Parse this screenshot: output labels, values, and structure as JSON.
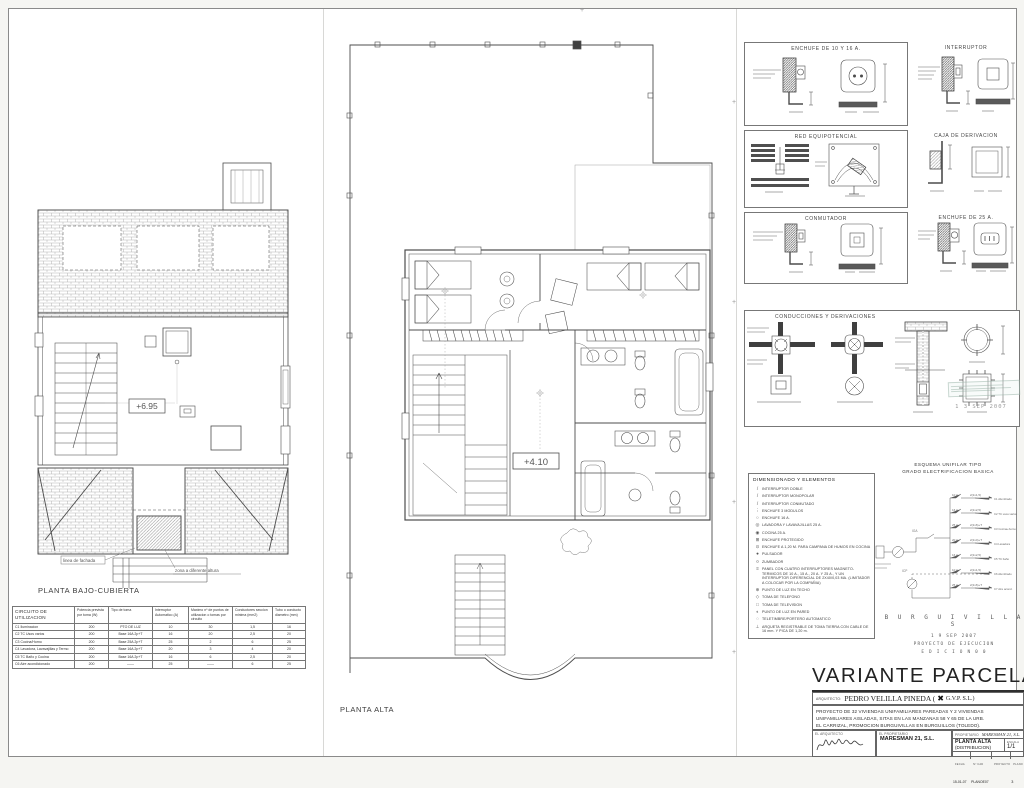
{
  "plans": {
    "left_label": "PLANTA BAJO-CUBIERTA",
    "center_label": "PLANTA ALTA",
    "level_left": "+6.95",
    "level_center": "+4.10",
    "ann_fachada": "linea de fachada",
    "ann_zona": "zona a diferente altura"
  },
  "details": {
    "boxes": [
      {
        "title": "ENCHUFE DE 10 Y 16 A."
      },
      {
        "title": "INTERRUPTOR"
      },
      {
        "title": "RED EQUIPOTENCIAL"
      },
      {
        "title": "CAJA DE DERIVACION"
      },
      {
        "title": "CONMUTADOR"
      },
      {
        "title": "ENCHUFE DE 25 A."
      },
      {
        "title": "CONDUCCIONES Y DERIVACIONES"
      }
    ]
  },
  "legend": {
    "title": "DIMENSIONADO Y ELEMENTOS",
    "items": [
      {
        "icon": "/",
        "text": "INTERRUPTOR DOBLE"
      },
      {
        "icon": "/",
        "text": "INTERRUPTOR MONOPOLAR"
      },
      {
        "icon": "/",
        "text": "INTERRUPTOR CONMUTADO"
      },
      {
        "icon": "⋮",
        "text": "ENCHUFE 3 MODULOS"
      },
      {
        "icon": "○",
        "text": "ENCHUFE 16 A."
      },
      {
        "icon": "◎",
        "text": "LAVADORA Y LAVAVAJILLAS 25 A."
      },
      {
        "icon": "◉",
        "text": "COCINA 25 A."
      },
      {
        "icon": "⊞",
        "text": "ENCHUFE PROTEGIDO"
      },
      {
        "icon": "⊙",
        "text": "ENCHUFE A 1,20 M. PARA CAMPANA DE HUMOS EN COCINA"
      },
      {
        "icon": "●",
        "text": "PULSADOR"
      },
      {
        "icon": "¤",
        "text": "ZUMBADOR"
      },
      {
        "icon": "≡",
        "text": "PANEL CON CUATRO INTERRUPTORES MAGNETO-TERMICOS DE 10 A., 15 A., 20 A. Y 25 A., Y UN INTERRUPTOR DIFERENCIAL DE 2X40/0,03 MA. (LIMITADOR A COLOCAR POR LA COMPAÑIA)"
      },
      {
        "icon": "⊕",
        "text": "PUNTO DE LUZ EN TECHO"
      },
      {
        "icon": "◇",
        "text": "TOMA DE TELEFONO"
      },
      {
        "icon": "□",
        "text": "TOMA DE TELEVISION"
      },
      {
        "icon": "◐",
        "text": "PUNTO DE LUZ EN PARED"
      },
      {
        "icon": "◌",
        "text": "TELETIMBRE/PORTERO AUTOMATICO"
      },
      {
        "icon": "⊥",
        "text": "ARQUETA REGISTRABLE DE TOMA TIERRA CON CABLE DE 16 mm. Y PICA DE 1,20 m."
      }
    ]
  },
  "esquema": {
    "title1": "ESQUEMA UNIFILAR TIPO",
    "title2": "GRADO ELECTRIFICACION BASICA",
    "branches": [
      {
        "breaker": "10 A",
        "wire": "2(1x1,5)",
        "label": "C1 Alumbrado"
      },
      {
        "breaker": "16 A",
        "wire": "2(1x2,5)",
        "label": "C2 TC usos varios"
      },
      {
        "breaker": "25 A",
        "wire": "2(1x6)+T",
        "label": "C3 Cocina+horno"
      },
      {
        "breaker": "20 A",
        "wire": "2(1x4)+T",
        "label": "C4 Lavadora"
      },
      {
        "breaker": "16 A",
        "wire": "2(1x2,5)",
        "label": "C5 TC baño"
      },
      {
        "breaker": "10 A",
        "wire": "2(1x1,5)",
        "label": "C6 Alumbrado"
      },
      {
        "breaker": "25 A",
        "wire": "2(1x6)+T",
        "label": "C7 Aire acond."
      }
    ]
  },
  "stamps": {
    "faded_date": "1 3  SEP  2007",
    "name": "B U R G U I V I L L A S",
    "date": "1 9  SEP  2007",
    "line2": "PROYECTO DE EJECUCION",
    "line3": "E D I C I O N   0 0"
  },
  "titleblock": {
    "big_title": "VARIANTE PARCELA 58/1",
    "architect_label": "ARQUITECTO:",
    "architect_name": "PEDRO VELILLA PINEDA (",
    "gvp_suffix": "G.V.P. S.L.)",
    "project_line1": "PROYECTO DE 32 VIVIENDAS UNIFAMILIARES PAREADAS Y 2 VIVIENDAS",
    "project_line2": "UNIFAMILIARES AISLADAS, SITAS EN LAS MANZANAS 58 Y 65 DE LA URB.",
    "project_line3": "EL CARRIZAL, PROMOCION BURGUIVILLAS EN BURGUILLOS (TOLEDO).",
    "el_arquitecto": "EL ARQUITECTO",
    "el_propietario": "EL PROPIETARIO",
    "propietario_label": "PROPIETARIO",
    "owner": "MARESMAN 21, S.L.",
    "owner_hand": "MARESMAN 21, S.L.",
    "sheet_title1": "PLANTA ALTA",
    "sheet_title2": "(DISTRIBUCION)",
    "escala_label": "ESCALA",
    "escala": "1/1",
    "fecha_label": "FECHA",
    "fecha": "15-01-07",
    "cad_label": "Nº CAD",
    "cad": "PLANOE07",
    "proyecto_label": "PROYECTO",
    "plano_label": "PLANO",
    "plano_num": "3"
  },
  "table": {
    "headers": [
      "CIRCUITO DE UTILIZACION",
      "Potencia prevista por toma (W)",
      "Tipo de toma",
      "Interruptor Automatico (A)",
      "Maximo nº de puntos de utilizacion o tomas por circuito",
      "Conductores seccion minima (mm2)",
      "Tubo o conducto diametro (mm)"
    ],
    "rows": [
      [
        "C1 Iluminacion",
        "200",
        "PTO DE LUZ",
        "10",
        "30",
        "1,5",
        "16"
      ],
      [
        "C2 TC Usos varios",
        "200",
        "Base 16A 2p+T",
        "16",
        "20",
        "2,5",
        "20"
      ],
      [
        "C3 Cocina/Horno",
        "200",
        "Base 25A 2p+T",
        "25",
        "2",
        "6",
        "25"
      ],
      [
        "C4 Lavadora, Lavavajillas y Termo",
        "200",
        "Base 16A 2p+T",
        "20",
        "3",
        "4",
        "20"
      ],
      [
        "C5 TC Baño y Cocina",
        "200",
        "Base 16A 2p+T",
        "16",
        "6",
        "2,5",
        "20"
      ],
      [
        "C6 Aire acondicionado",
        "200",
        "——",
        "25",
        "——",
        "6",
        "25"
      ]
    ]
  }
}
